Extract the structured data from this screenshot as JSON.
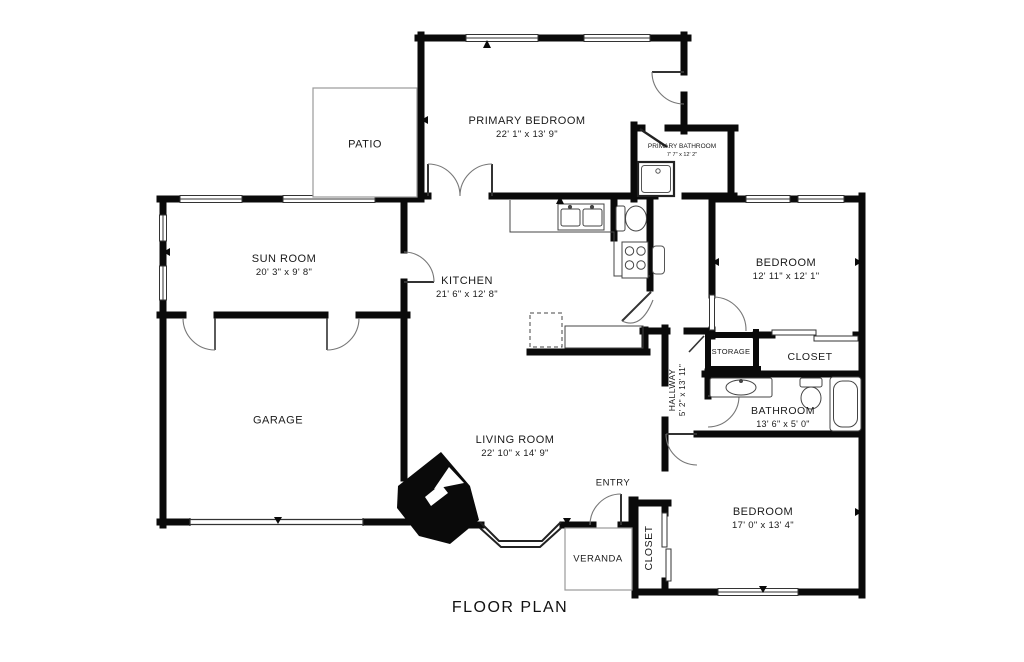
{
  "title": "FLOOR PLAN",
  "rooms": {
    "primary_bedroom": {
      "name": "PRIMARY BEDROOM",
      "dims": "22' 1\" x 13' 9\""
    },
    "patio": {
      "name": "PATIO"
    },
    "primary_bathroom": {
      "name": "PRIMARY BATHROOM",
      "dims": "7' 7\" x 12' 2\""
    },
    "sun_room": {
      "name": "SUN ROOM",
      "dims": "20' 3\" x 9' 8\""
    },
    "kitchen": {
      "name": "KITCHEN",
      "dims": "21' 6\" x 12' 8\""
    },
    "bedroom_top_right": {
      "name": "BEDROOM",
      "dims": "12' 11\" x 12' 1\""
    },
    "garage": {
      "name": "GARAGE"
    },
    "storage": {
      "name": "STORAGE"
    },
    "closet_top_right": {
      "name": "CLOSET"
    },
    "hallway": {
      "name": "HALLWAY",
      "dims": "5' 2\" x 13' 11\""
    },
    "bathroom": {
      "name": "BATHROOM",
      "dims": "13' 6\" x 5' 0\""
    },
    "living_room": {
      "name": "LIVING ROOM",
      "dims": "22' 10\" x 14' 9\""
    },
    "entry": {
      "name": "ENTRY"
    },
    "bedroom_bottom_right": {
      "name": "BEDROOM",
      "dims": "17' 0\" x 13' 4\""
    },
    "veranda": {
      "name": "VERANDA"
    },
    "closet_bottom_right": {
      "name": "CLOSET"
    }
  },
  "colors": {
    "wall": "#0a0a0a",
    "fixture": "#444444",
    "outdoor_outline": "#9a9a9a",
    "text": "#1a1a1a",
    "background": "#ffffff"
  }
}
